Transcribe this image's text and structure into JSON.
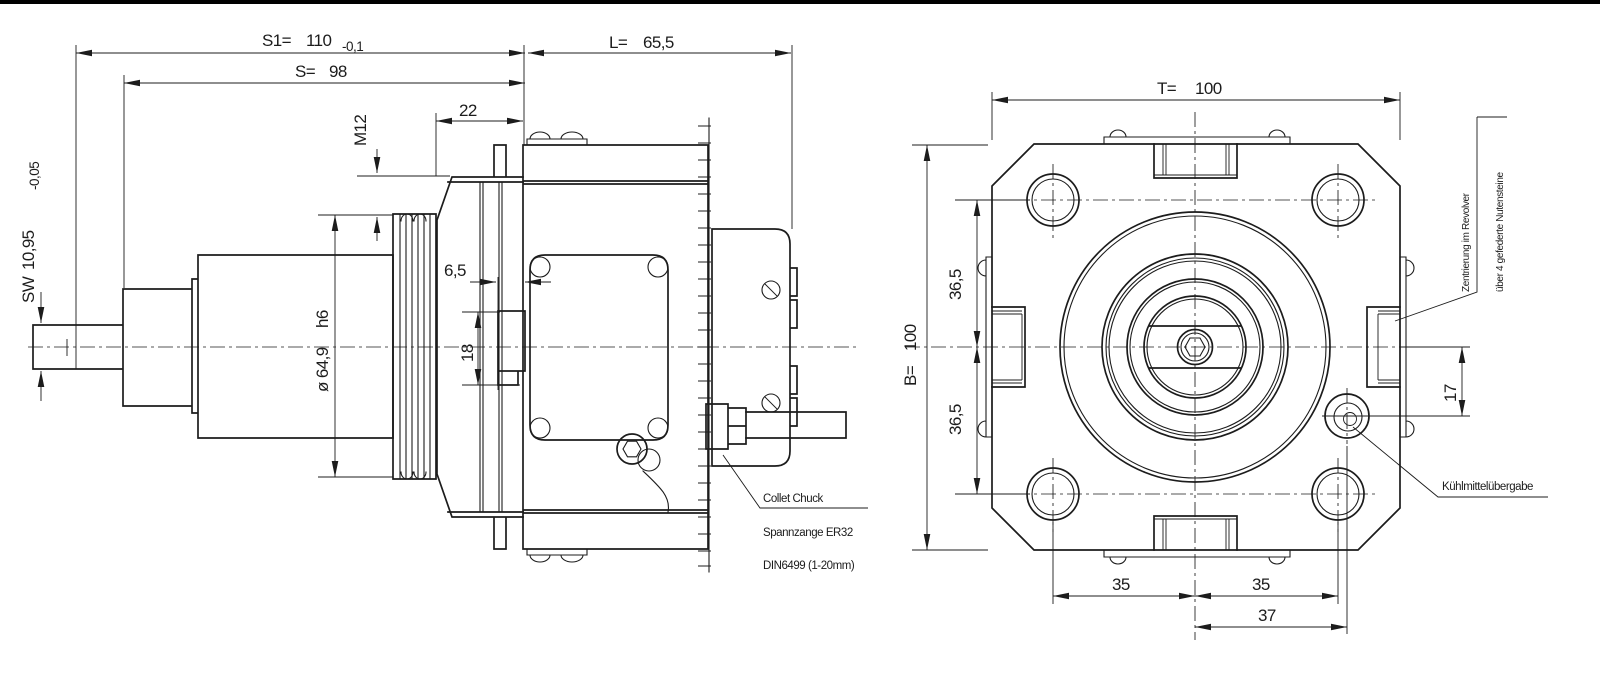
{
  "colors": {
    "ink": "#1c1c1c",
    "background": "#ffffff"
  },
  "side": {
    "s1_label": "S1=",
    "s1_value": "110",
    "s1_tol": "-0,1",
    "s_label": "S=",
    "s_value": "98",
    "l_label": "L=",
    "l_value": "65,5",
    "dim_width": "22",
    "thread": "M12",
    "sw_label": "SW",
    "sw_value": "10,95",
    "sw_tol": "-0,05",
    "diameter": "ø 64,9",
    "fit": "h6",
    "dim_recess": "6,5",
    "dim_spigot": "18",
    "note_en": "Collet Chuck",
    "note_de": "Spannzange ER32",
    "note_din": "DIN6499 (1-20mm)"
  },
  "front": {
    "t_label": "T=",
    "t_value": "100",
    "b_label": "B=",
    "b_value": "100",
    "dim_hole_upper": "36,5",
    "dim_hole_lower": "36,5",
    "dim_hole_left": "35",
    "dim_hole_right": "35",
    "dim_coolant_x": "37",
    "dim_coolant_y": "17",
    "note_centering_1": "Zentrierung im Revolver",
    "note_centering_2": "über 4 gefederte Nutensteine",
    "note_coolant": "Kühlmittelübergabe"
  }
}
